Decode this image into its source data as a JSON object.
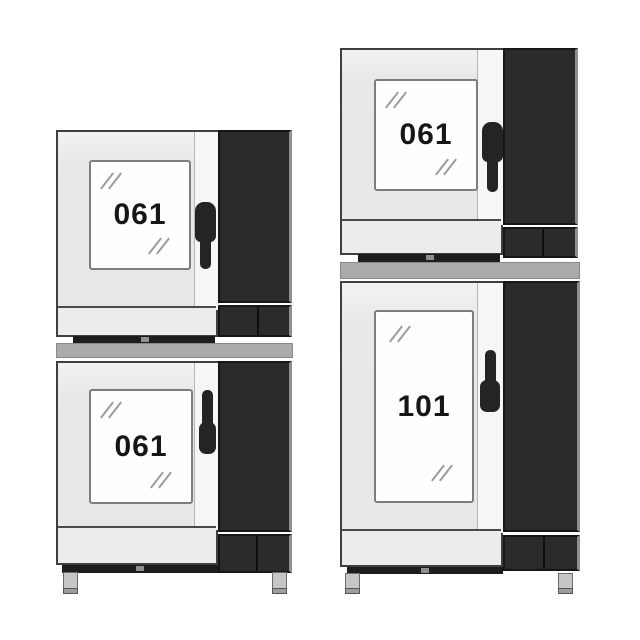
{
  "colors": {
    "background": "#ffffff",
    "oven_body": "#e9e9e9",
    "side_panel": "#2b2b2b",
    "door_window": "#fefefe",
    "handle": "#242424",
    "stacking_band": "#ababab",
    "plinth_bar": "#1d1d1d",
    "foot": "#c6c6c6",
    "label_text": "#161616",
    "reflection": "#9c9c9c"
  },
  "icons": {
    "door_handle": "vertical-grip-css-shape",
    "glass_reflection": "double-slash-marks"
  },
  "stacks": [
    {
      "id": "left",
      "units": [
        {
          "model": "061"
        },
        {
          "model": "061"
        }
      ]
    },
    {
      "id": "right",
      "units": [
        {
          "model": "061"
        },
        {
          "model": "101"
        }
      ]
    }
  ]
}
